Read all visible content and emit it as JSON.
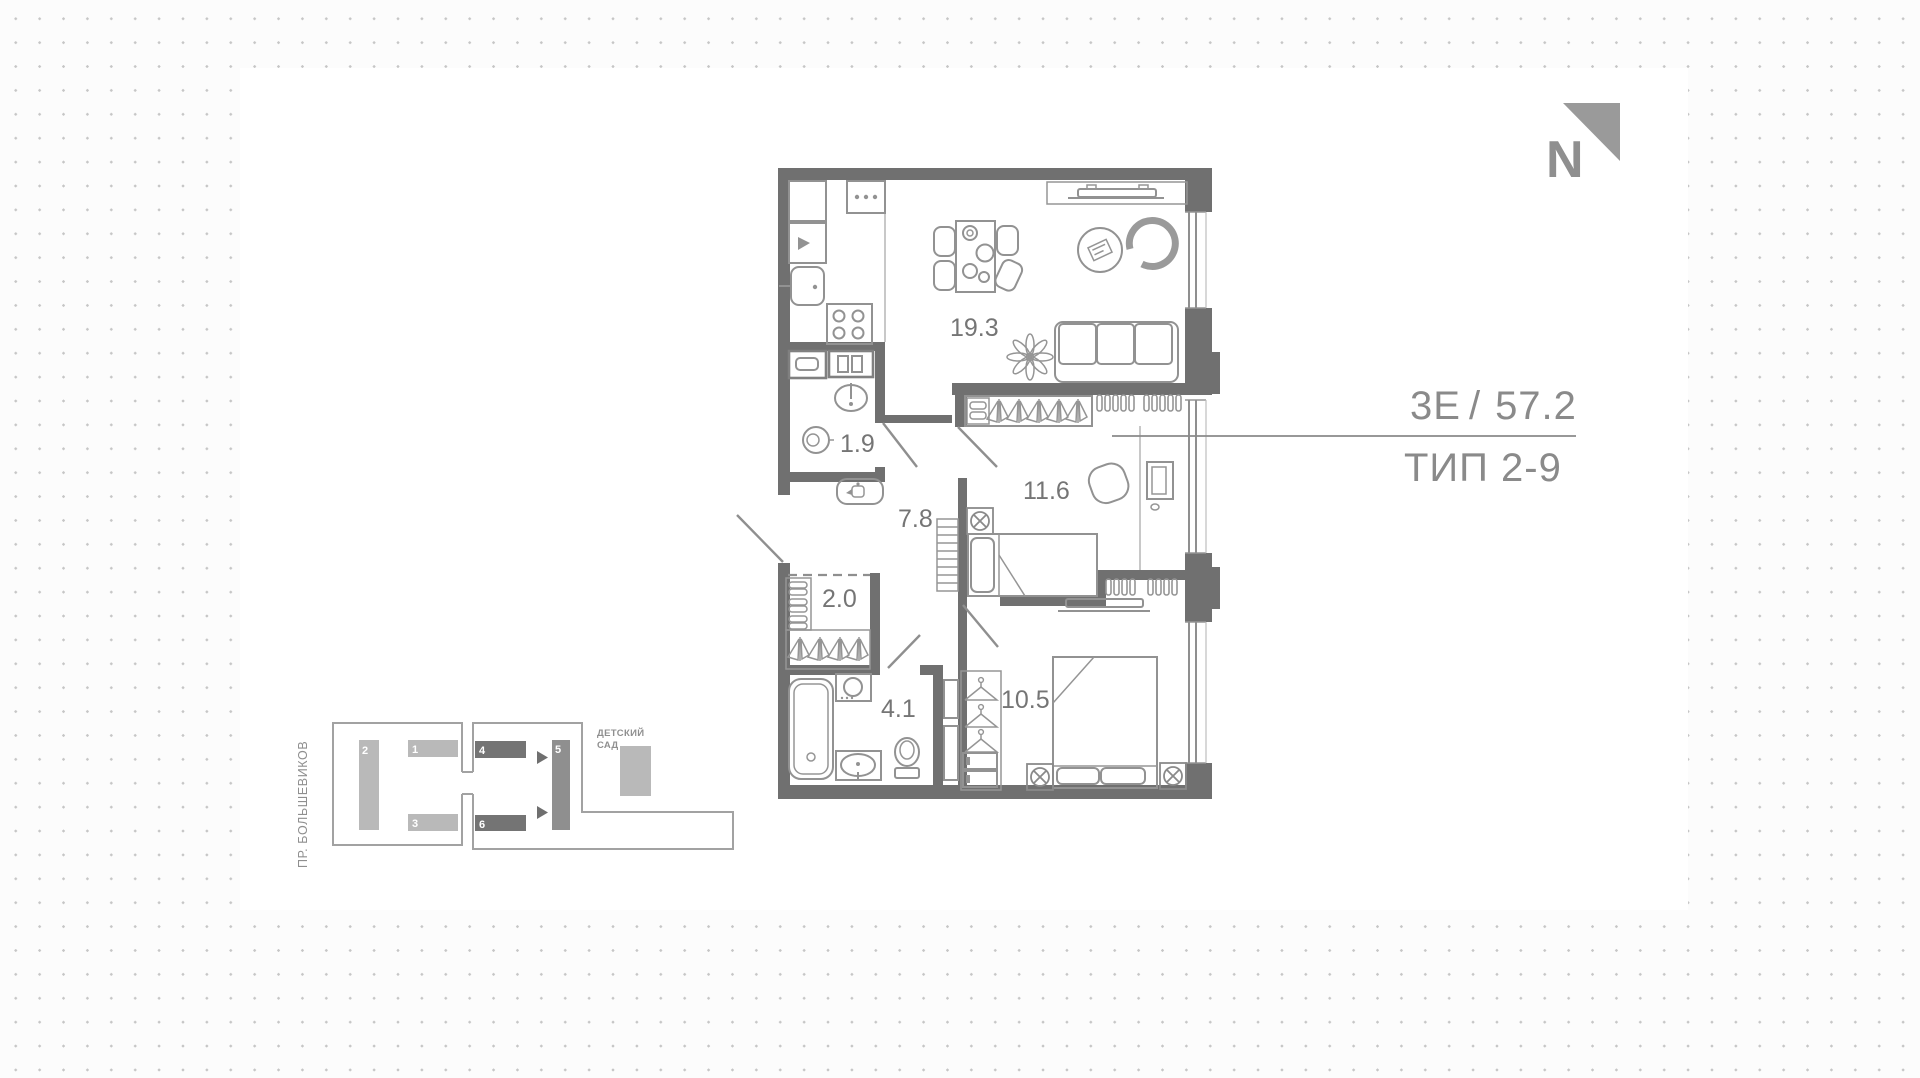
{
  "header": {
    "plan_code": "3Е",
    "divider": "/",
    "area_m2": "57.2",
    "type_label": "ТИП 2-9"
  },
  "north_label": "N",
  "rooms": {
    "living_kitchen": "19.3",
    "bathroom_small": "1.9",
    "hallway": "7.8",
    "bedroom_1": "11.6",
    "storage": "2.0",
    "bathroom": "4.1",
    "bedroom_2": "10.5"
  },
  "site_plan": {
    "street": "ПР. БОЛЬШЕВИКОВ",
    "kindergarten_line1": "ДЕТСКИЙ",
    "kindergarten_line2": "САД",
    "buildings": [
      "1",
      "2",
      "3",
      "4",
      "5",
      "6"
    ]
  },
  "colors": {
    "walls": "#707070",
    "furniture_stroke": "#929292",
    "text_gray": "#8a8a8a",
    "building_light": "#b9b9b9",
    "building_dark": "#747474",
    "building_mid": "#8f8f8f",
    "dot_grid": "#c6c6c6",
    "panel": "#ffffff"
  }
}
